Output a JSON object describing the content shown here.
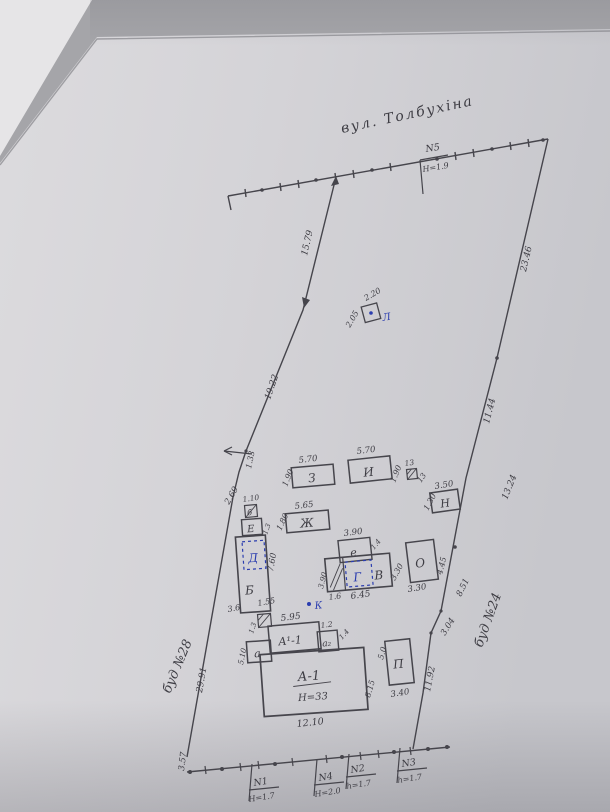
{
  "plan": {
    "street": "вул. Толбухіна",
    "markers": {
      "n5": {
        "id": "N5",
        "h": "Н=1.9"
      },
      "n1": {
        "id": "N1",
        "h": "Н=1.7"
      },
      "n4": {
        "id": "N4",
        "h": "Н=2.0"
      },
      "n2": {
        "id": "N2",
        "h": "h=1.7"
      },
      "n3": {
        "id": "N3",
        "h": "h=1.7"
      }
    },
    "boundary": {
      "nw": "15.79",
      "w1": "19.22",
      "w2": "1.33",
      "w3": "2.69",
      "w4": "29.91",
      "sw": "3.57",
      "ne": "23.46",
      "e1": "11.44",
      "e2": "13.24",
      "e3": "8.51",
      "e4": "3.04",
      "e5": "11.92"
    },
    "neighbors": {
      "west": "буд №28",
      "east": "буд №24"
    },
    "buildings": {
      "L": {
        "label": "Л",
        "d1": "2.05",
        "d2": "2.20"
      },
      "Z": {
        "label": "З",
        "top": "5.70",
        "side": "1.90"
      },
      "I": {
        "label": "И",
        "top": "5.70",
        "side": "1.90"
      },
      "shed13": {
        "top": "13",
        "side": "13"
      },
      "N": {
        "label": "Н",
        "top": "3.50",
        "side": "1.30"
      },
      "Zh": {
        "label": "Ж",
        "top": "5.65",
        "side": "1.80"
      },
      "b": {
        "label": "б",
        "top": "1.10"
      },
      "E": {
        "label": "Е",
        "side": "1.3"
      },
      "B": {
        "label": "Б",
        "side": "7.60",
        "bottom": "3.6",
        "gap": "1.55"
      },
      "D": {
        "label": "Д"
      },
      "e": {
        "label": "е",
        "top": "3.90",
        "side": "1.4"
      },
      "V": {
        "label": "В",
        "bottom": "6.45",
        "bottom_left": "1.6",
        "left": "3.90",
        "right": "3.30"
      },
      "G": {
        "label": "Г"
      },
      "O": {
        "label": "О",
        "side": "4.45",
        "bottom": "3.30"
      },
      "K": {
        "label": "К"
      },
      "a": {
        "label": "а",
        "side": "5.10"
      },
      "a1_annex": {
        "label": "А¹-1",
        "top": "5.95"
      },
      "a2": {
        "label": "а₂",
        "top": "1.2",
        "side": "1.4"
      },
      "shed_a": {
        "side": "1.3"
      },
      "A1": {
        "label": "А-1",
        "note": "Н=33",
        "bottom": "12.10",
        "side": "8.15"
      },
      "P": {
        "label": "П",
        "side": "5.0",
        "bottom": "3.40"
      }
    }
  }
}
